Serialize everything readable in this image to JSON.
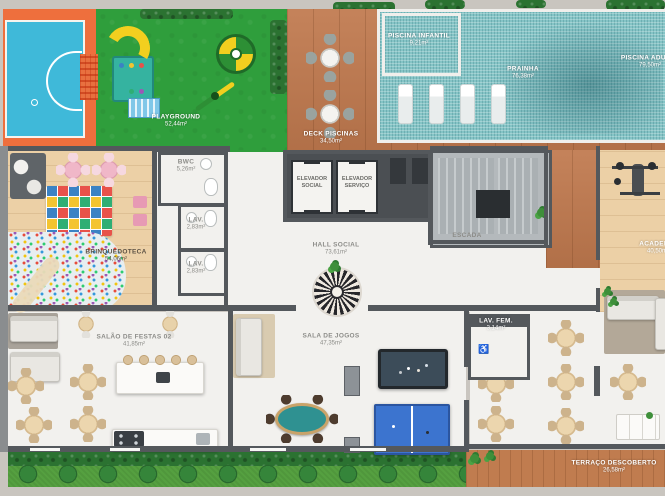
{
  "rooms": {
    "playground": {
      "name": "PLAYGROUND",
      "area": "52,44m²"
    },
    "deck_piscinas": {
      "name": "DECK PISCINAS",
      "area": "34,50m²"
    },
    "piscina_infantil": {
      "name": "PISCINA INFANTIL",
      "area": "9,21m²"
    },
    "prainha": {
      "name": "PRAINHA",
      "area": "76,38m²"
    },
    "piscina_adulto": {
      "name": "PISCINA ADULTO",
      "area": "79,50m²"
    },
    "brinquedoteca": {
      "name": "BRINQUEDOTECA",
      "area": "54,06m²"
    },
    "bwc": {
      "name": "BWC",
      "area": "5,26m²"
    },
    "lav_1": {
      "name": "LAV.",
      "area": "2,83m²"
    },
    "lav_2": {
      "name": "LAV.",
      "area": "2,83m²"
    },
    "elevador_social": {
      "name": "ELEVADOR",
      "sub": "SOCIAL"
    },
    "elevador_servico": {
      "name": "ELEVADOR",
      "sub": "SERVIÇO"
    },
    "escada": {
      "name": "ESCADA"
    },
    "hall_social": {
      "name": "HALL SOCIAL",
      "area": "73,61m²"
    },
    "academia": {
      "name": "ACADEMIA",
      "area": "40,50m²"
    },
    "salao_festas_02": {
      "name": "SALÃO DE FESTAS 02",
      "area": "41,85m²"
    },
    "sala_jogos": {
      "name": "SALA DE JOGOS",
      "area": "47,35m²"
    },
    "lav_fem": {
      "name": "LAV. FEM.",
      "area": "3,14m²"
    },
    "terraco": {
      "name": "TERRAÇO DESCOBERTO",
      "area": "26,58m²"
    }
  },
  "icons": {
    "wheelchair": "♿"
  },
  "palette": {
    "pool_tile": "#85c4c6",
    "court_orange": "#ee6f3d",
    "court_blue": "#3fb9d9",
    "playground_green": "#2f9e3c",
    "deck_wood": "#c0794e",
    "light_wood": "#ecd0a6",
    "wall_gray": "#54585c",
    "floor_white": "#f2f1ee",
    "grass_green": "#55a040",
    "hedge_green": "#2b7231",
    "pingpong_blue": "#3c74cf"
  }
}
